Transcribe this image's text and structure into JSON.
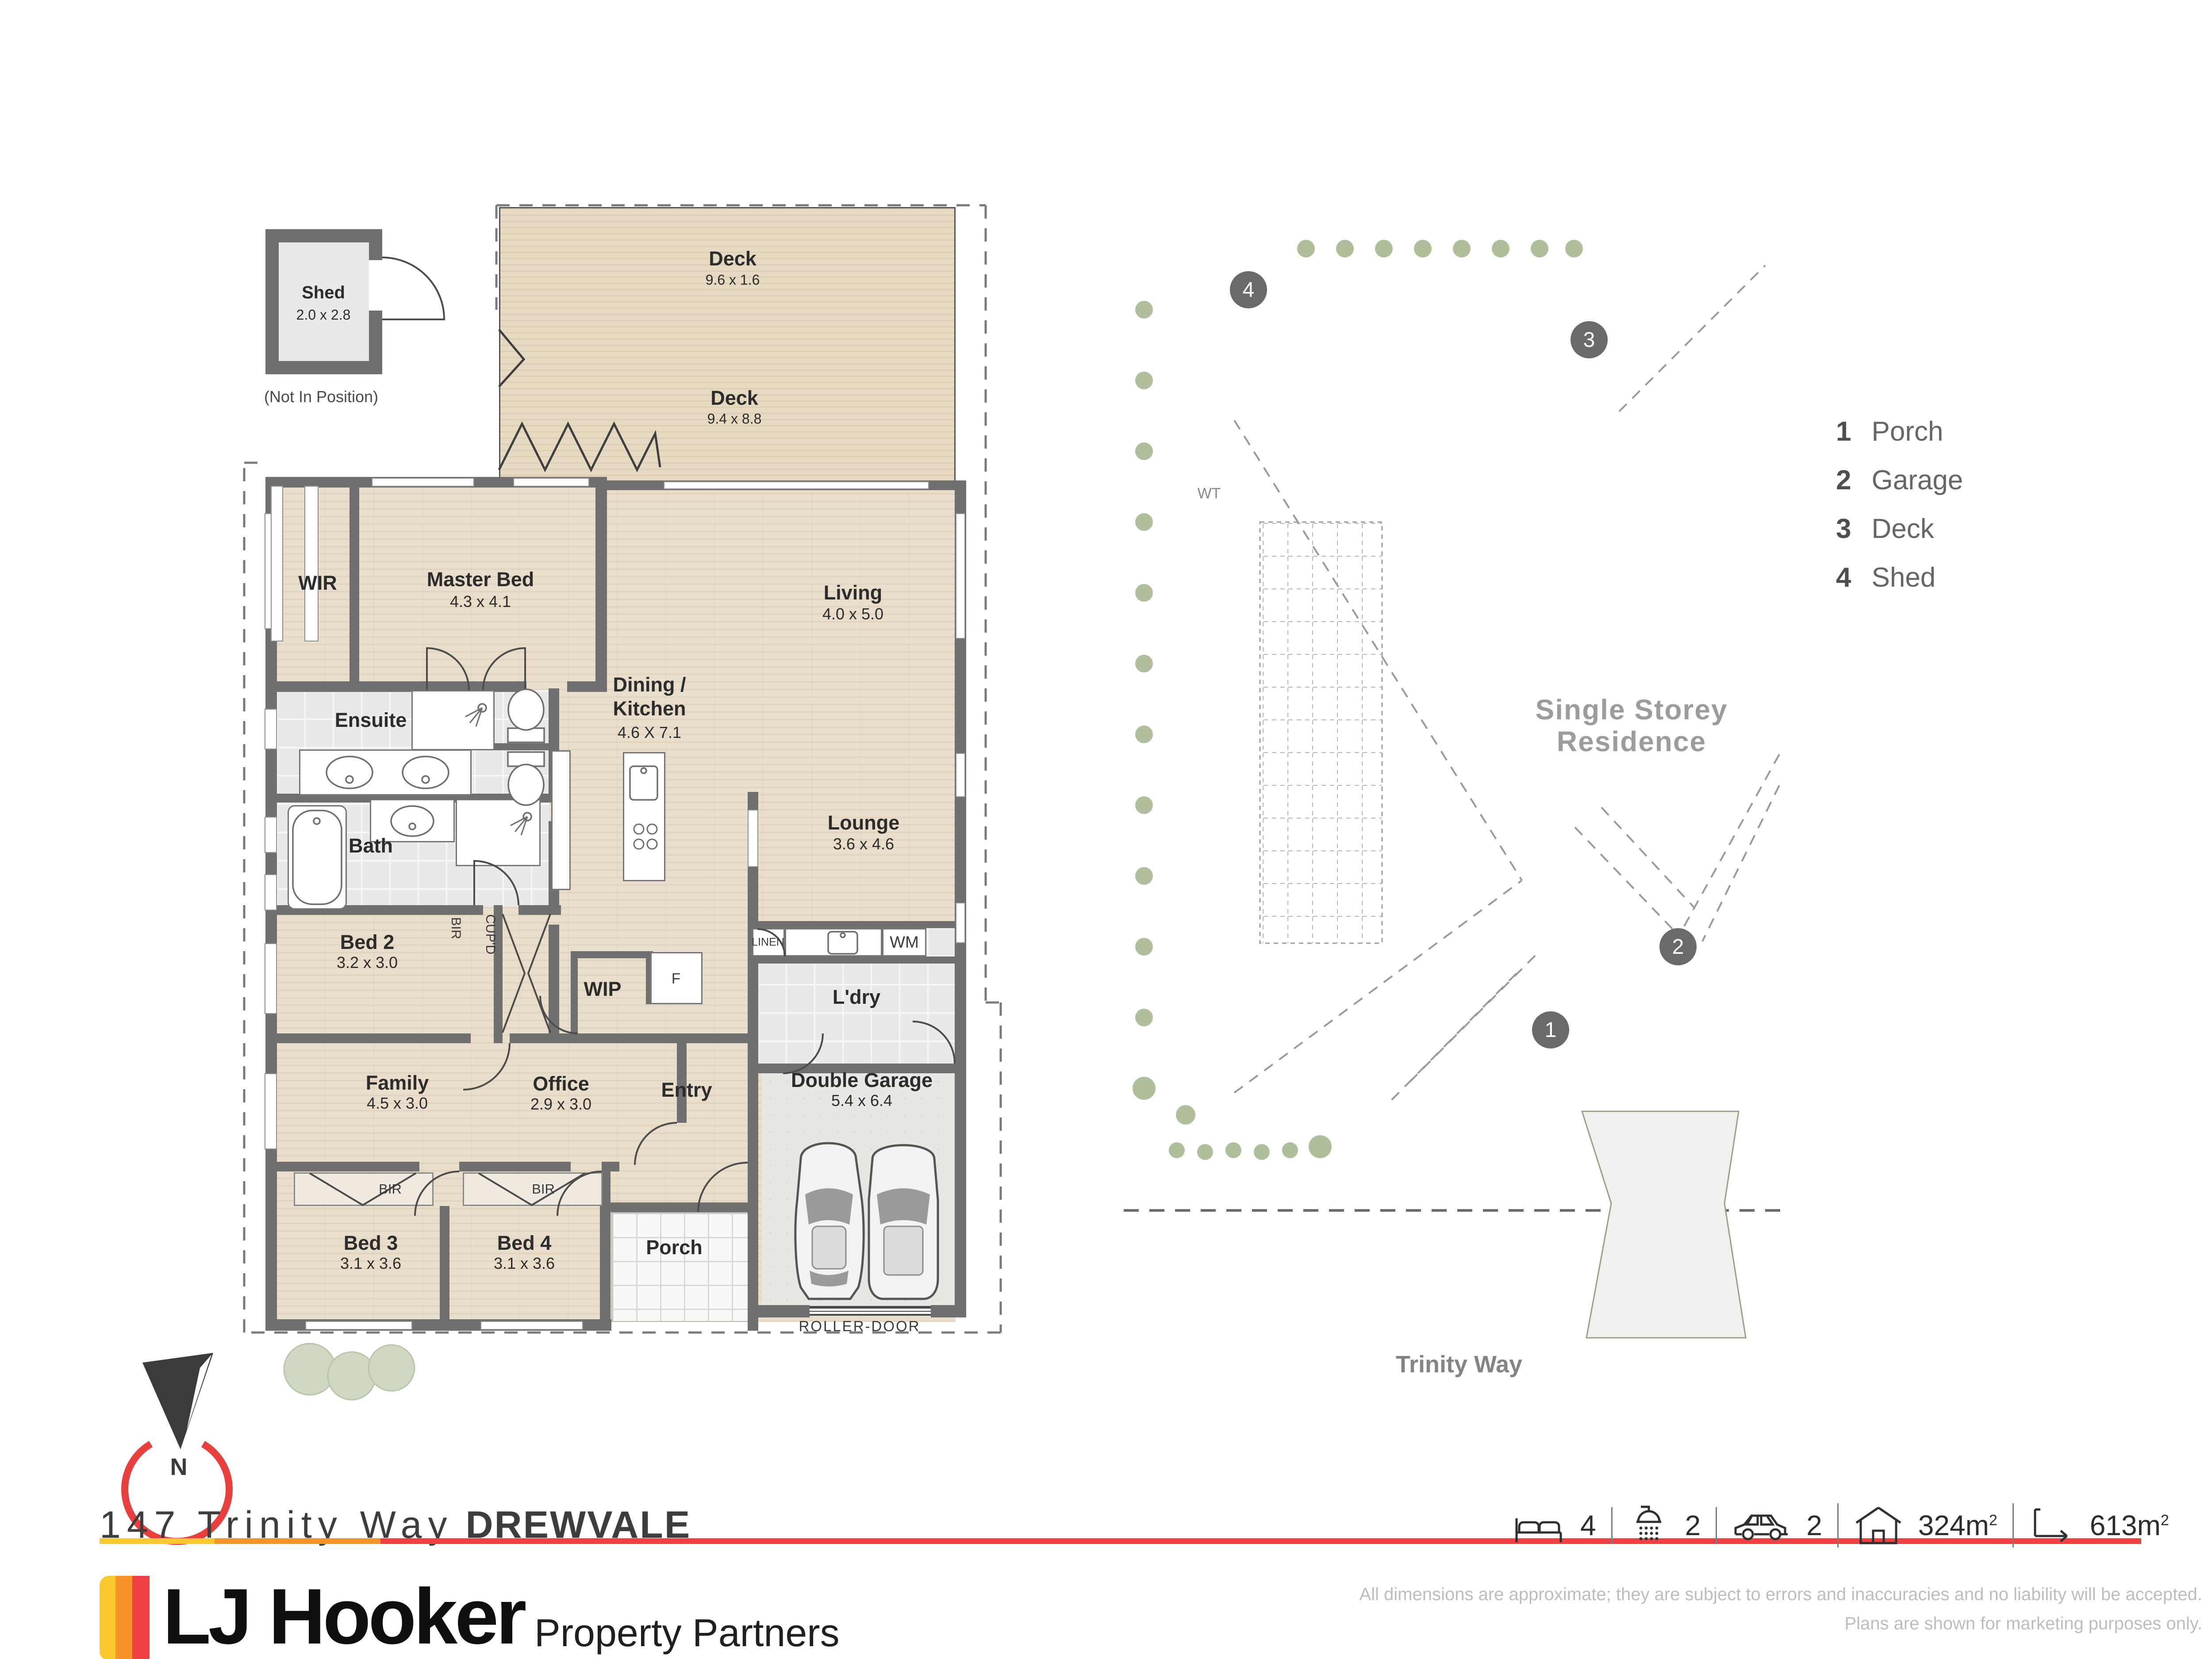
{
  "colors": {
    "accent_yellow": "#fdc82f",
    "accent_orange": "#f79429",
    "accent_red": "#ef4043",
    "wall_gray": "#6f6f6f",
    "lot_green": "#a8b78c"
  },
  "floorplan": {
    "shed": {
      "name": "Shed",
      "dims": "2.0 x 2.8",
      "note": "(Not In Position)"
    },
    "deck_top": {
      "name": "Deck",
      "dims": "9.6 x 1.6"
    },
    "deck_main": {
      "name": "Deck",
      "dims": "9.4 x 8.8"
    },
    "wir": {
      "name": "WIR"
    },
    "master": {
      "name": "Master Bed",
      "dims": "4.3 x 4.1"
    },
    "living": {
      "name": "Living",
      "dims": "4.0 x 5.0"
    },
    "dining": {
      "name_line1": "Dining /",
      "name_line2": "Kitchen",
      "dims": "4.6 X 7.1"
    },
    "ensuite": {
      "name": "Ensuite"
    },
    "bath": {
      "name": "Bath"
    },
    "lounge": {
      "name": "Lounge",
      "dims": "3.6 x 4.6"
    },
    "bed2": {
      "name": "Bed 2",
      "dims": "3.2 x 3.0"
    },
    "bir": {
      "name": "BIR"
    },
    "cupd": {
      "name": "CUP'D"
    },
    "wip": {
      "name": "WIP"
    },
    "fridge": {
      "name": "F"
    },
    "linen": {
      "name": "LINEN"
    },
    "wm": {
      "name": "WM"
    },
    "ldry": {
      "name": "L'dry"
    },
    "family": {
      "name": "Family",
      "dims": "4.5 x 3.0"
    },
    "office": {
      "name": "Office",
      "dims": "2.9 x 3.0"
    },
    "entry": {
      "name": "Entry"
    },
    "garage": {
      "name": "Double Garage",
      "dims": "5.4 x 6.4"
    },
    "bed3": {
      "name": "Bed 3",
      "dims": "3.1 x 3.6"
    },
    "bed4": {
      "name": "Bed 4",
      "dims": "3.1 x 3.6"
    },
    "bir_bed3": {
      "name": "BIR"
    },
    "bir_bed4": {
      "name": "BIR"
    },
    "porch": {
      "name": "Porch"
    },
    "roller_door": {
      "name": "ROLLER-DOOR"
    }
  },
  "siteplan": {
    "residence_line1": "Single Storey",
    "residence_line2": "Residence",
    "street": "Trinity Way",
    "water_tank": "WT",
    "markers": {
      "porch": "1",
      "garage": "2",
      "deck": "3",
      "shed": "4"
    },
    "legend": [
      {
        "num": "1",
        "label": "Porch"
      },
      {
        "num": "2",
        "label": "Garage"
      },
      {
        "num": "3",
        "label": "Deck"
      },
      {
        "num": "4",
        "label": "Shed"
      }
    ]
  },
  "compass": {
    "north": "N"
  },
  "footer": {
    "address_street": "147 Trinity Way",
    "address_suburb": "DREWVALE",
    "stats": {
      "beds": "4",
      "baths": "2",
      "cars": "2",
      "floor_area": "324m",
      "floor_area_exp": "2",
      "land_area": "613m",
      "land_area_exp": "2"
    },
    "brand_name": "LJ Hooker",
    "brand_tagline": "Property Partners",
    "disclaimer_line1": "All dimensions are approximate; they are subject to errors and inaccuracies and no liability will be accepted.",
    "disclaimer_line2": "Plans are shown for marketing purposes only."
  }
}
